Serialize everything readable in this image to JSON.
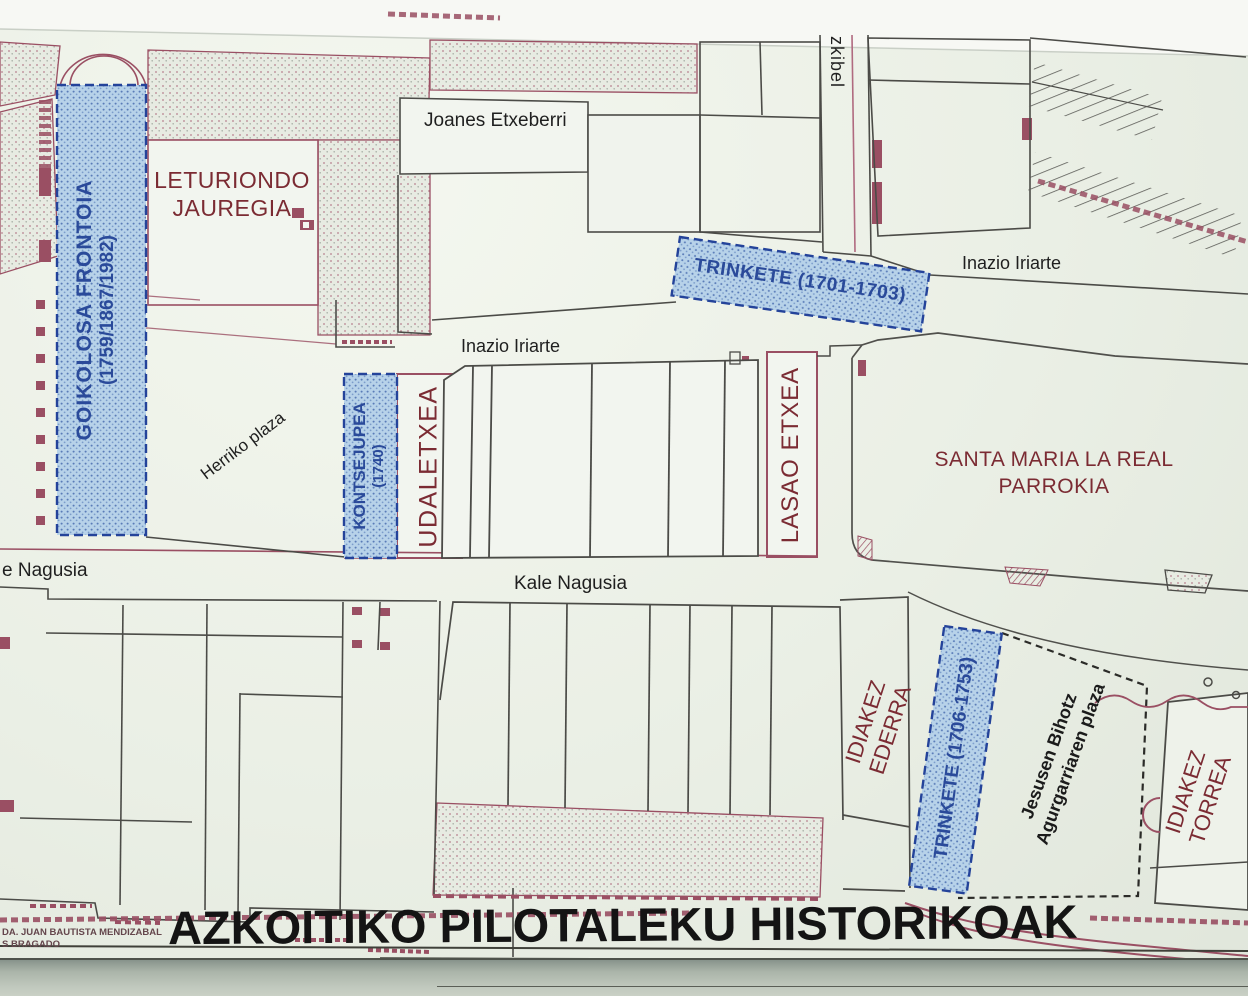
{
  "map": {
    "title": "AZKOITIKO PILOTALEKU HISTORIKOAK",
    "credit": {
      "line1": "DA. JUAN BAUTISTA MENDIZABAL",
      "line2": "S BRAGADO"
    },
    "streets": {
      "joanes_etxeberri": "Joanes Etxeberri",
      "inazio_iriarte_right": "Inazio Iriarte",
      "inazio_iriarte_center": "Inazio Iriarte",
      "kale_nagusia": "Kale Nagusia",
      "kale_nagusia_partial": "e Nagusia",
      "aizkibel_partial": "zkibel",
      "herriko_plaza": "Herriko plaza",
      "jesusen_bihotz_line1": "Jesusen Bihotz",
      "jesusen_bihotz_line2": "Agurgarriaren plaza"
    },
    "buildings": {
      "leturiondo_line1": "LETURIONDO",
      "leturiondo_line2": "JAUREGIA",
      "udaletxea": "UDALETXEA",
      "lasao_etxea": "LASAO ETXEA",
      "santa_maria_line1": "SANTA MARIA LA REAL",
      "santa_maria_line2": "PARROKIA",
      "idiakez_ederra_line1": "IDIAKEZ",
      "idiakez_ederra_line2": "EDERRA",
      "idiakez_torrea_line1": "IDIAKEZ",
      "idiakez_torrea_line2": "TORREA"
    },
    "pelota_courts": {
      "goikolosa_name": "GOIKOLOSA FRONTOIA",
      "goikolosa_years": "(1759/1867/1982)",
      "trinkete_1701": "TRINKETE (1701-1703)",
      "kontsejupea_name": "KONTSEJUPEA",
      "kontsejupea_years": "(1740)",
      "trinkete_1706": "TRINKETE (1706-1753)"
    },
    "colors": {
      "court_fill": "#b7d2e9",
      "court_border": "#24439a",
      "court_text": "#2a4a9a",
      "building_text": "#7b2b33",
      "street_text": "#1f1f1f",
      "line_maroon": "#9a4f63",
      "line_black": "#4b4b47",
      "paper": "#eaefe5"
    }
  }
}
